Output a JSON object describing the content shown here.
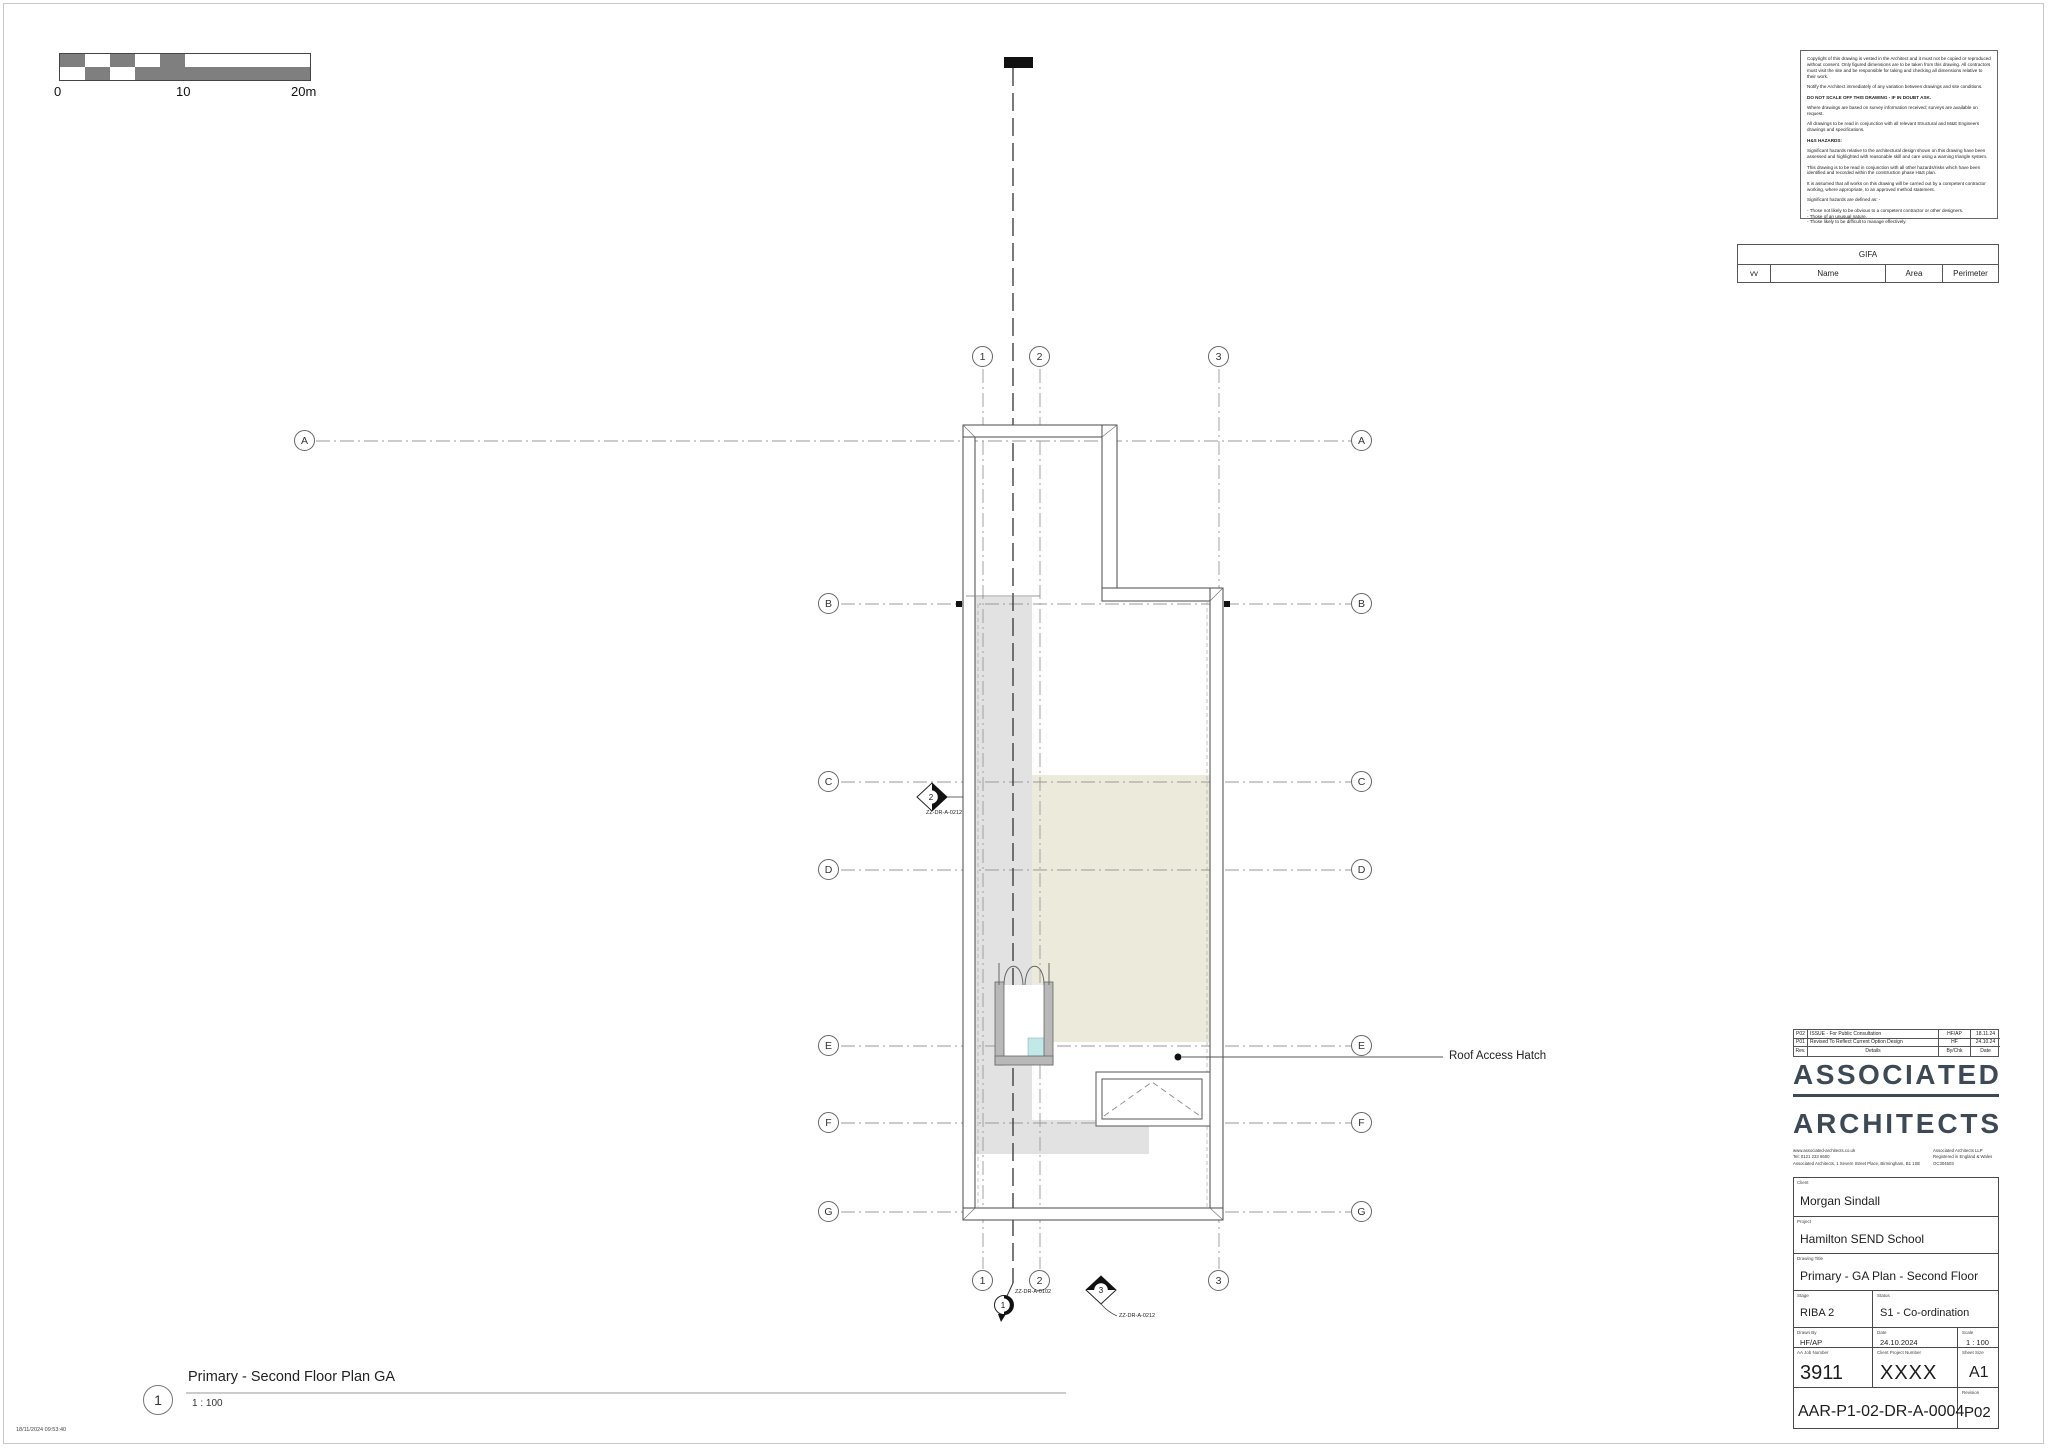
{
  "sheet": {
    "timestamp": "18/11/2024 09:53:40"
  },
  "scale_bar": {
    "label_0": "0",
    "label_10": "10",
    "label_20": "20m"
  },
  "notes": {
    "p0": "Copyright of this drawing is vested in the Architect and it must not be copied or reproduced without consent. Only figured dimensions are to be taken from this drawing.  All contractors must visit the site and be responsible for taking and checking all dimensions relative to their work.",
    "p1": "Notify the Architect immediately of any variation between drawings and site conditions.",
    "p2": "DO NOT SCALE OFF THIS DRAWING - IF IN DOUBT ASK.",
    "p3": "Where drawings are based on survey information received; surveys are available on request.",
    "p4": "All drawings to be read in conjunction with all relevant Structural and M&E Engineers drawings and specifications.",
    "p5": "H&S HAZARDS:",
    "p6": "Significant hazards relative to the architectural design shown on this drawing have been assessed and highlighted with reasonable skill and care using a warning triangle system.",
    "p7": "This drawing is to be read in conjunction with all other hazards/risks which have been identified and recorded within the construction phase H&S plan.",
    "p8": "It is assumed that all works on this drawing will be carried out by a competent contractor working, where appropriate, to an approved method statement.",
    "p9": "Significant hazards are defined as: -",
    "p10": "- Those not likely to be obvious to a competent contractor or other designers.",
    "p11": "- Those of an unusual nature.",
    "p12": "- Those likely to be difficult to manage effectively."
  },
  "gifa": {
    "title": "GIFA",
    "col_vv": "vv",
    "col_name": "Name",
    "col_area": "Area",
    "col_perimeter": "Perimeter"
  },
  "plan": {
    "grid_cols": [
      "1",
      "2",
      "3"
    ],
    "grid_rows": [
      "A",
      "B",
      "C",
      "D",
      "E",
      "F",
      "G"
    ],
    "roof_access_hatch_label": "Roof Access Hatch",
    "section_markers": [
      {
        "num": "1",
        "ref": "ZZ-DR-A-0102"
      },
      {
        "num": "2",
        "ref": "ZZ-DR-A-0212"
      },
      {
        "num": "3",
        "ref": "ZZ-DR-A-0212"
      }
    ],
    "view_title": {
      "number": "1",
      "title": "Primary - Second Floor Plan GA",
      "scale": "1 : 100"
    }
  },
  "title_block": {
    "revisions": [
      {
        "rev": "P02",
        "details": "ISSUE - For Public Consultation",
        "by": "HF/AP",
        "date": "18.11.24"
      },
      {
        "rev": "P01",
        "details": "Revised To Reflect Current Option Design",
        "by": "HF",
        "date": "24.10.24"
      }
    ],
    "revision_header": {
      "rev": "Rev.",
      "details": "Details",
      "by": "By/Chk",
      "date": "Date"
    },
    "logo": {
      "line1": "ASSOCIATED",
      "line2": "ARCHITECTS"
    },
    "contact": {
      "web": "www.associated-architects.co.uk",
      "tel": "Tel: 0121 233 6600",
      "address": "Associated Architects, 1 Severn Street Place, Birmingham,  B1 1SE",
      "llp": "Associated Architects LLP",
      "registered": "Registered in England & Wales",
      "company_no": "OC304503"
    },
    "labels": {
      "client": "Client",
      "project": "Project",
      "drawing_title": "Drawing Title",
      "stage": "Stage",
      "status": "Status",
      "drawn_by": "Drawn By",
      "date": "Date",
      "scale": "Scale",
      "job": "AA Job Number",
      "client_project": "Client Project Number",
      "sheet_size": "Sheet Size",
      "revision": "Revision"
    },
    "values": {
      "client": "Morgan Sindall",
      "project": "Hamilton SEND School",
      "drawing_title": "Primary - GA Plan - Second Floor",
      "stage": "RIBA 2",
      "status": "S1 - Co-ordination",
      "drawn_by": "HF/AP",
      "date": "24.10.2024",
      "scale": "1 : 100",
      "job": "3911",
      "client_project": "XXXX",
      "sheet_size": "A1",
      "drawing_number": "AAR-P1-02-DR-A-0004",
      "revision": "P02"
    }
  },
  "colors": {
    "logo": "#3d4a55",
    "roof_beige": "#ecebdb",
    "core_gray": "#e2e2e2",
    "glazing_cyan": "#c2e8e8",
    "scalebar_gray": "#7f7f7f"
  }
}
